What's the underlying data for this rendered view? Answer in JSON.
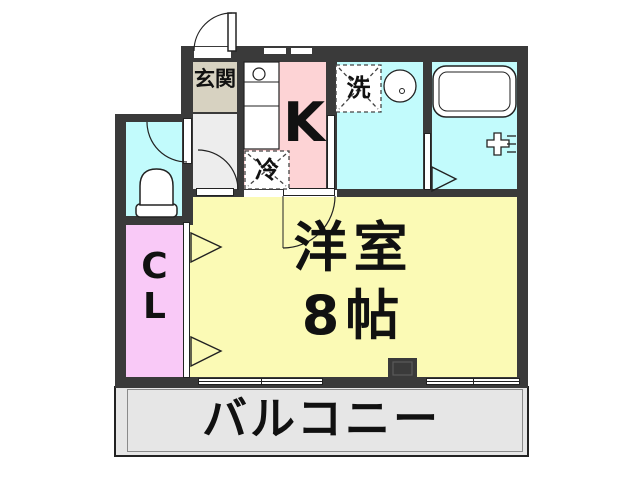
{
  "floorplan": {
    "rooms": {
      "genkan": {
        "label": "玄関"
      },
      "kitchen": {
        "label": "K"
      },
      "refrigerator_space": {
        "label": "冷"
      },
      "washer_space": {
        "label": "洗"
      },
      "closet": {
        "line1": "C",
        "line2": "L"
      },
      "western_room": {
        "line1": "洋室",
        "line2": "8帖"
      },
      "balcony": {
        "label": "バルコニー"
      }
    },
    "colors": {
      "wall": "#3a3a3a",
      "water_rooms": "#c2fbfc",
      "kitchen": "#fdd3d5",
      "genkan": "#d7d2c1",
      "hallway": "#ededed",
      "closet": "#f9c9f7",
      "room": "#fbfab5",
      "balcony": "#e6e6e6"
    }
  }
}
